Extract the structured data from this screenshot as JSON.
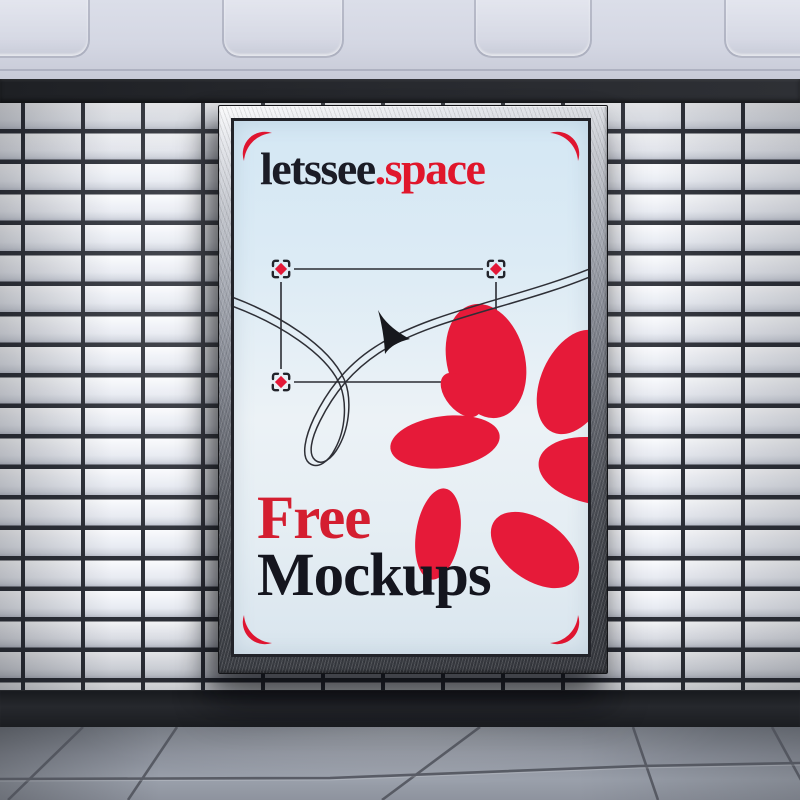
{
  "poster": {
    "brand_prefix": "letssee",
    "brand_suffix": ".space",
    "headline_line1": "Free",
    "headline_line2": "Mockups"
  },
  "colors": {
    "accent_red": "#e2182f",
    "ink_dark": "#15161f",
    "poster_background_blue": "#d8e9f4",
    "frame_silver": "#c9ccd3",
    "wall_tile_white": "#eef1f7",
    "tile_joint_dark": "#2d3038",
    "floor_gray": "#8f95a0",
    "trim_band_dark": "#26282c"
  },
  "icons": {
    "corner_brackets": "corner-bracket-icon",
    "selection_handles": "selection-handle-icon",
    "cursor": "cursor-arrow-icon",
    "flower": "flower-petals-icon",
    "flourish": "flourish-line"
  }
}
